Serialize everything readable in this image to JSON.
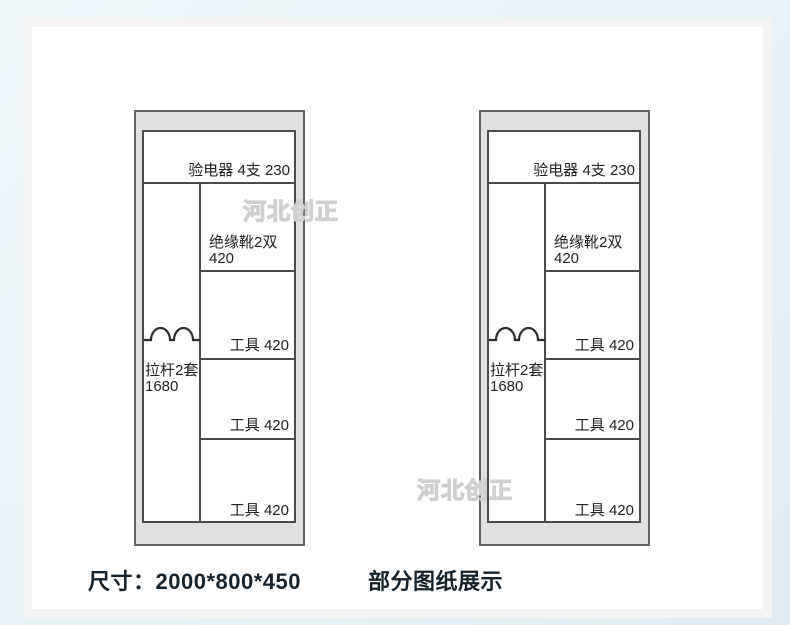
{
  "colors": {
    "background": "#e7f1f6",
    "card": "#ffffff",
    "card_border": "#f3f3f3",
    "cabinet_fill": "#e0e0e0",
    "cabinet_border": "#606060",
    "line": "#4a4a4a",
    "label_text": "#222222",
    "watermark": "#cfcfcf",
    "footer_text": "#15222c"
  },
  "watermark": {
    "text": "河北创正"
  },
  "cabinet": {
    "top_shelf_label": "验电器 4支 230",
    "left_column": {
      "line1": "拉杆2套",
      "line2": "1680"
    },
    "right_rows": [
      {
        "line1": "绝缘靴2双",
        "line2": "420"
      },
      {
        "label": "工具 420"
      },
      {
        "label": "工具 420"
      },
      {
        "label": "工具 420"
      }
    ]
  },
  "footer": {
    "dimensions": "尺寸：2000*800*450",
    "note": "部分图纸展示"
  }
}
